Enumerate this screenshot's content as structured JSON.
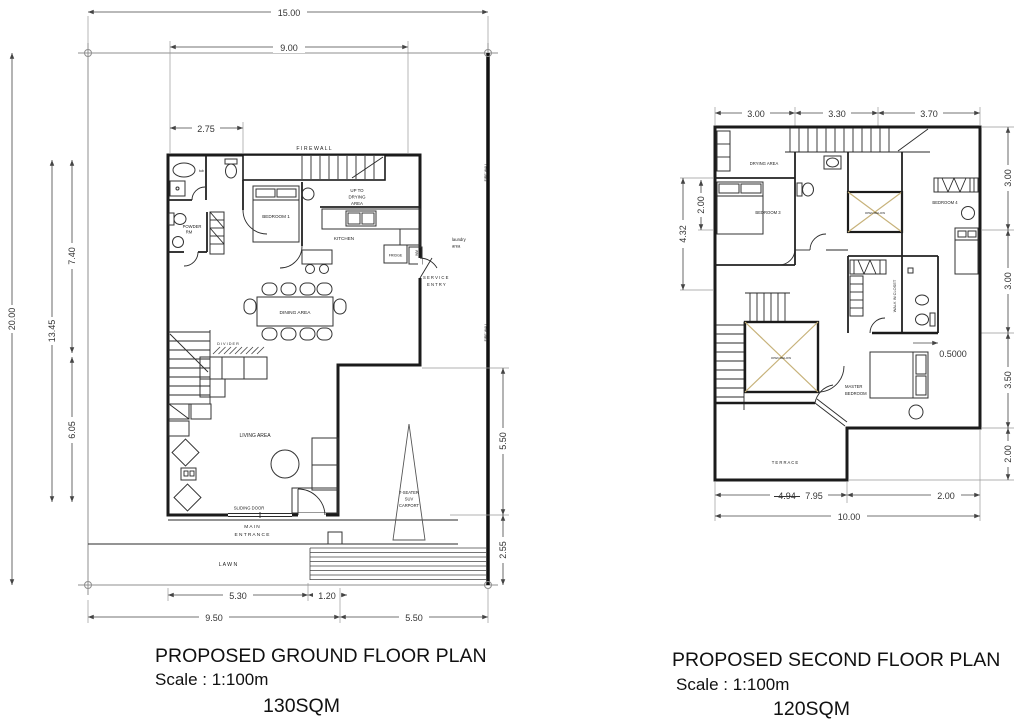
{
  "drawing": {
    "type": "architectural-floor-plans",
    "colors": {
      "walls": "#1b1b1b",
      "lot_lines": "#8f8f8f",
      "dimension_lines": "#444444",
      "void_x_marks": "#c7b27a",
      "background": "#ffffff"
    }
  },
  "ground_floor": {
    "title": "PROPOSED GROUND FLOOR PLAN",
    "scale": "Scale : 1:100m",
    "area": "130SQM",
    "rooms": {
      "firewall": "F I R E W A L L",
      "firewall_side": "FIRE WALL",
      "bedroom1": "BEDROOM 1",
      "kitchen": "KITCHEN",
      "fridge": "FRIDGE",
      "wm": "WM",
      "tub": "tub",
      "powder_line1": "POWDER",
      "powder_line2": "RM",
      "up_to_1": "UP TO",
      "up_to_2": "DRYING",
      "up_to_3": "AREA",
      "laundry_1": "laundry",
      "laundry_2": "area",
      "service_1": "S E R V I C E",
      "service_2": "E N T R Y",
      "dining": "DINING AREA",
      "divider": "D I V I D E R",
      "living": "LIVING AREA",
      "sliding_door": "SLIDING DOOR",
      "main_1": "M A I N",
      "main_2": "E N T R A N C E",
      "lawn": "L    A    W    N",
      "carport_1": "7-SEATER",
      "carport_2": "SUV",
      "carport_3": "CARPORT"
    },
    "dims": {
      "top_overall": "15.00",
      "top_inner": "9.00",
      "bath_width": "2.75",
      "left_overall": "20.00",
      "left_building": "13.45",
      "left_upper": "7.40",
      "left_lower": "6.05",
      "right_upper": "5.50",
      "right_lower": "2.55",
      "bottom_lawn": "5.30",
      "bottom_walk": "1.20",
      "bottom_left": "9.50",
      "bottom_right": "5.50"
    }
  },
  "second_floor": {
    "title": "PROPOSED SECOND FLOOR PLAN",
    "scale": "Scale : 1:100m",
    "area": "120SQM",
    "rooms": {
      "drying": "DRYING AREA",
      "bedroom3": "BEDROOM 3",
      "bedroom4": "BEDROOM 4",
      "walk_in_closet": "WALK IN CLOSET",
      "master_1": "MASTER",
      "master_2": "BEDROOM",
      "terrace": "T E R R A C E",
      "void_label": "OPEN BELOW"
    },
    "dims": {
      "top_1": "3.00",
      "top_2": "3.30",
      "top_3": "3.70",
      "left_outer": "4.32",
      "left_inner": "2.00",
      "right_1": "3.00",
      "right_2": "3.00",
      "right_3": "3.50",
      "right_4": "2.00",
      "offset": "0.5000",
      "bottom_struck": "4.94",
      "bottom_main": "7.95",
      "bottom_right": "2.00",
      "bottom_overall": "10.00"
    }
  }
}
